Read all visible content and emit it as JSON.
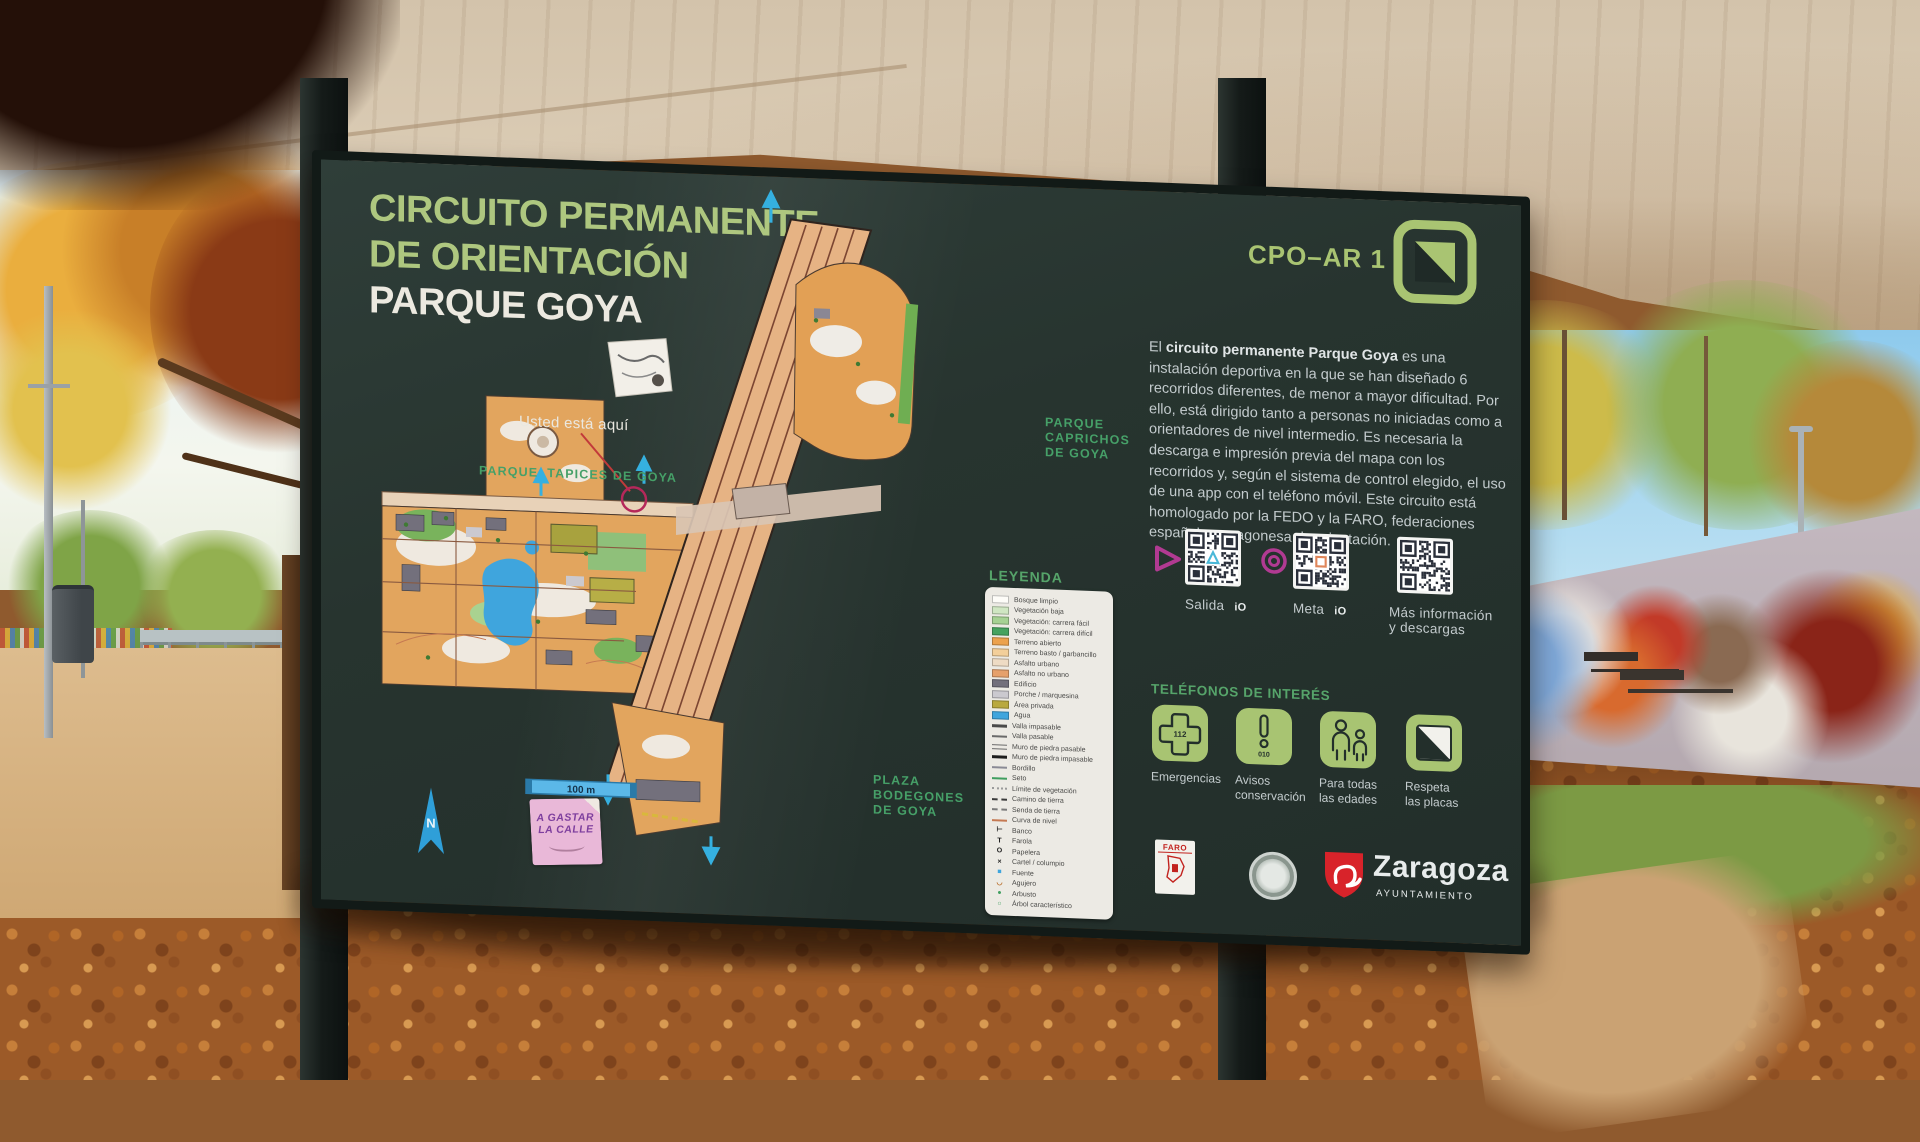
{
  "colors": {
    "accent_green": "#a9c472",
    "heading_green": "#56a46a",
    "board": "#27342f",
    "magenta": "#b13a92",
    "arrow_cyan": "#35b0e0",
    "zaragoza_red": "#d8232a"
  },
  "sign": {
    "title_line1": "CIRCUITO PERMANENTE",
    "title_line2": "DE ORIENTACIÓN",
    "title_line3": "PARQUE GOYA",
    "code": "CPO–AR 1",
    "intro": {
      "prefix": "El ",
      "bold": "circuito permanente Parque Goya",
      "rest": " es una instalación deportiva en la que se han diseñado 6 recorridos diferentes, de menor a mayor dificultad. Por ello, está dirigido tanto a personas no iniciadas como a orientadores de nivel intermedio. Es necesaria la descarga e impresión previa del mapa con los recorridos y, según el sistema de control elegido, el uso de una app con el teléfono móvil. Este circuito está homologado por la FEDO y la FARO, federaciones española y aragonesa de orientación."
    },
    "qr": [
      {
        "label": "Salida",
        "badge": "iO"
      },
      {
        "label": "Meta",
        "badge": "iO"
      },
      {
        "label": "Más información\ny descargas"
      }
    ],
    "phones": {
      "heading": "TELÉFONOS DE INTERÉS",
      "items": [
        {
          "label": "Emergencias",
          "number": "112"
        },
        {
          "label": "Avisos\nconservación",
          "number": "010"
        },
        {
          "label": "Para todas\nlas edades",
          "number": ""
        },
        {
          "label": "Respeta\nlas placas",
          "number": ""
        }
      ]
    },
    "map": {
      "you_are_here": "Usted está aquí",
      "park_top": "PARQUE  TAPICES DE GOYA",
      "park_right": [
        "PARQUE",
        "CAPRICHOS",
        "DE GOYA"
      ],
      "plaza_bottom": [
        "PLAZA",
        "BODEGONES",
        "DE GOYA"
      ],
      "scale_label": "100 m",
      "north_label": "N",
      "sticker_line1": "A GASTAR",
      "sticker_line2": "LA CALLE"
    },
    "legend": {
      "title": "LEYENDA",
      "items": [
        {
          "label": "Bosque limpio",
          "kind": "fill",
          "color": "#fdfcf8"
        },
        {
          "label": "Vegetación baja",
          "kind": "fill",
          "color": "#cfe6c2"
        },
        {
          "label": "Vegetación: carrera fácil",
          "kind": "fill",
          "color": "#a5d193"
        },
        {
          "label": "Vegetación: carrera difícil",
          "kind": "fill",
          "color": "#46a25f"
        },
        {
          "label": "Terreno abierto",
          "kind": "fill",
          "color": "#eca24d"
        },
        {
          "label": "Terreno basto / garbancillo",
          "kind": "fill",
          "color": "#f3cf9a"
        },
        {
          "label": "Asfalto urbano",
          "kind": "fill",
          "color": "#eedbc4"
        },
        {
          "label": "Asfalto no urbano",
          "kind": "fill",
          "color": "#e6a06b"
        },
        {
          "label": "Edificio",
          "kind": "fill",
          "color": "#73707c"
        },
        {
          "label": "Porche / marquesina",
          "kind": "fill",
          "color": "#cbc9cf"
        },
        {
          "label": "Área privada",
          "kind": "fill",
          "color": "#b9a93f"
        },
        {
          "label": "Agua",
          "kind": "fill",
          "color": "#3fa5dd"
        },
        {
          "label": "Valla impasable",
          "kind": "thick",
          "color": "#4a4a4a"
        },
        {
          "label": "Valla pasable",
          "kind": "line",
          "color": "#6a6a6a"
        },
        {
          "label": "Muro de piedra pasable",
          "kind": "double",
          "color": "#6a6a6a"
        },
        {
          "label": "Muro de piedra impasable",
          "kind": "thick",
          "color": "#1d1d1d"
        },
        {
          "label": "Bordillo",
          "kind": "line",
          "color": "#8a8a95"
        },
        {
          "label": "Seto",
          "kind": "line",
          "color": "#3f9e5f"
        },
        {
          "label": "Límite de vegetación",
          "kind": "dots",
          "color": "#9a9a9a"
        },
        {
          "label": "Camino de tierra",
          "kind": "dash",
          "color": "#3a3a3a"
        },
        {
          "label": "Senda de tierra",
          "kind": "dash",
          "color": "#7a7a7a"
        },
        {
          "label": "Curva de nivel",
          "kind": "line",
          "color": "#c57952"
        },
        {
          "label": "Banco",
          "kind": "sym",
          "sym": "⊢",
          "color": "#1d1d1d"
        },
        {
          "label": "Farola",
          "kind": "sym",
          "sym": "T",
          "color": "#1d1d1d"
        },
        {
          "label": "Papelera",
          "kind": "sym",
          "sym": "O",
          "color": "#1d1d1d"
        },
        {
          "label": "Cartel / columpio",
          "kind": "sym",
          "sym": "×",
          "color": "#1d1d1d"
        },
        {
          "label": "Fuente",
          "kind": "sym",
          "sym": "■",
          "color": "#3fa5dd"
        },
        {
          "label": "Agujero",
          "kind": "sym",
          "sym": "◡",
          "color": "#b5651d"
        },
        {
          "label": "Arbusto",
          "kind": "sym",
          "sym": "●",
          "color": "#3f9e5f"
        },
        {
          "label": "Árbol característico",
          "kind": "sym",
          "sym": "○",
          "color": "#3f9e5f"
        }
      ]
    },
    "logos": {
      "faro_text": "FARO",
      "zaragoza": "Zaragoza",
      "zaragoza_sub": "AYUNTAMIENTO"
    }
  }
}
